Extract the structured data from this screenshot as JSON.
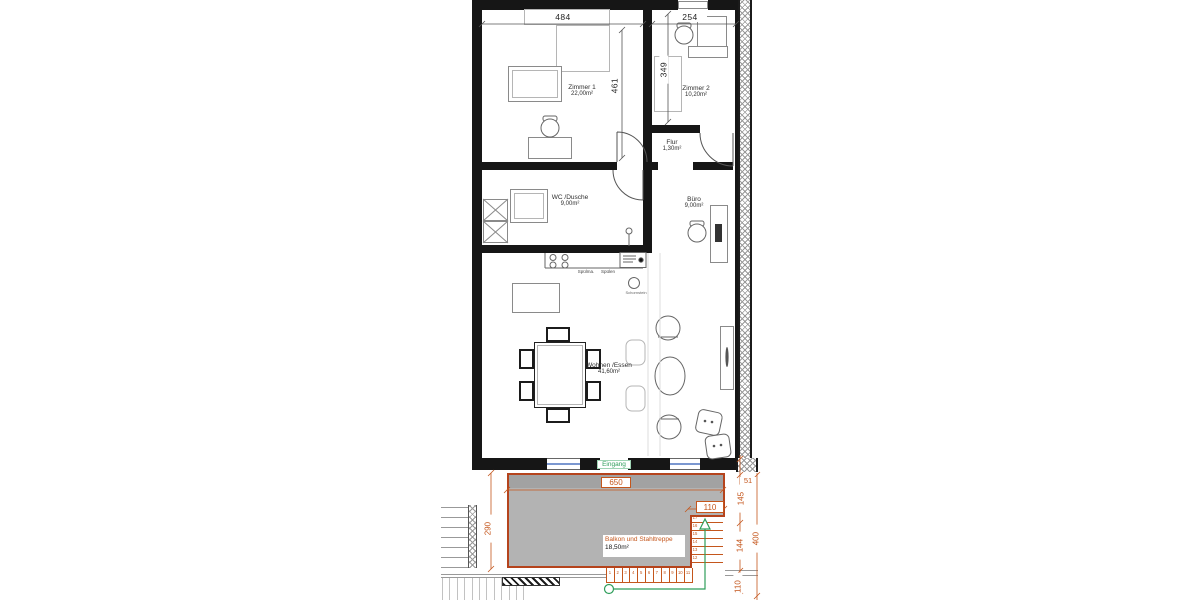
{
  "drawing": {
    "type": "floor-plan",
    "language": "de"
  },
  "rooms": {
    "zimmer1": {
      "name": "Zimmer 1",
      "area": "22,00m²"
    },
    "zimmer2": {
      "name": "Zimmer 2",
      "area": "10,20m²"
    },
    "flur": {
      "name": "Flur",
      "area": "1,30m²"
    },
    "wc": {
      "name": "WC /Dusche",
      "area": "9,00m²"
    },
    "buero": {
      "name": "Büro",
      "area": "9,00m²"
    },
    "wohnen": {
      "name": "Wohnen /Essen",
      "area": "41,60m²"
    },
    "balkon": {
      "name": "Balkon und Stahltreppe",
      "area": "18,50m²"
    }
  },
  "dimensions": {
    "zimmer1_width": "484",
    "zimmer2_width": "254",
    "zimmer1_depth": "461",
    "zimmer2_depth": "349",
    "balkon_width": "650",
    "balkon_depth": "290",
    "stair_width": "110",
    "right_offset": "51",
    "right_upper": "145",
    "right_mid": "144",
    "right_total": "400",
    "right_lower": "110"
  },
  "labels": {
    "entrance": "Eingang",
    "dishwasher": "Spülma.",
    "sink": "Spülen",
    "chimney": "Schornstein"
  },
  "stairs": {
    "lower_run": [
      "1",
      "2",
      "3",
      "4",
      "5",
      "6",
      "7",
      "8",
      "9",
      "10",
      "11"
    ],
    "upper_run": [
      "12",
      "13",
      "14",
      "15",
      "16",
      "17"
    ]
  },
  "colors": {
    "walls": "#161616",
    "dimension_orange": "#c4561c",
    "balcony_border": "#b5431c",
    "balcony_fill": "#b3b3b3",
    "entrance_green": "#2f9e5b",
    "window_blue": "#7b97d0"
  }
}
